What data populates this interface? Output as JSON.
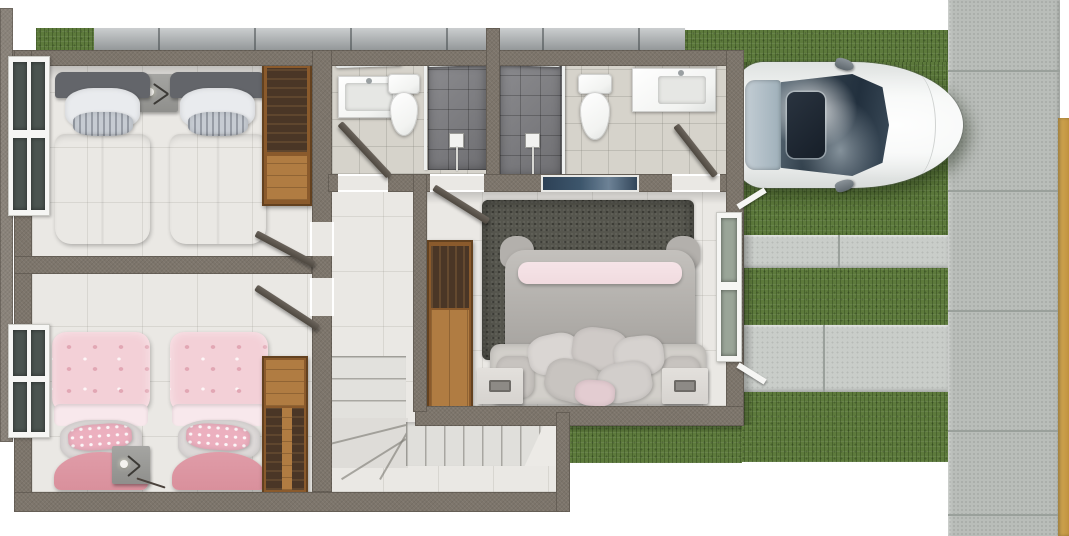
{
  "scene": {
    "type": "3d-floor-plan-top-view",
    "description": "Top-down 3D architectural rendering of an upper floor: two twin bedrooms on the left, two bathrooms at top center, a master bedroom at center right, an L-shaped staircase, and an exterior driveway with a parked white car, grass strips and a paver sidewalk"
  },
  "palette": {
    "background": "#ffffff",
    "wall": "#7d756b",
    "wall_dark": "#8a837a",
    "fence_stone": "#a8adaf",
    "floor": "#eae8e4",
    "bath_floor": "#d6d3cb",
    "shower_tile": "#7e7e82",
    "porcelain": "#f2f3f1",
    "wood": "#b07c42",
    "wood_mid": "#8a5a2c",
    "wood_dark": "#4a3626",
    "gray_bed_duvet": "#d4d8dc",
    "gray_bed_headboard": "#63656a",
    "pink_duvet": "#f3d0d7",
    "pink_accent": "#e2a7b4",
    "pink_blanket": "#d9909c",
    "master_duvet": "#b7b4b0",
    "master_pink_fold": "#f1dbdf",
    "master_headboard": "#d2cfca",
    "master_nightstand": "#d6d3cf",
    "rug": "#56564e",
    "grass": "#5d7a3c",
    "concrete_strip": "#c9cdc9",
    "sidewalk": "#b9bdb9",
    "paver_joint": "#9aa09b",
    "curb_tan": "#d2a853",
    "car_body": "#f4f6f5",
    "car_glass": "#2e3c48",
    "window_glass": "#4b5450",
    "window_blue": "#3d566c",
    "door": "#4e4840"
  },
  "house": {
    "rooms": [
      {
        "name": "twin bedroom gray",
        "beds": 2,
        "bedding": "light gray",
        "items": [
          "dark headboards",
          "nightstand with lamp",
          "wood wardrobe",
          "left window",
          "open door"
        ]
      },
      {
        "name": "twin bedroom pink",
        "beds": 2,
        "bedding": "pink patterned",
        "items": [
          "rose foot blankets",
          "nightstand with lamp",
          "wood wardrobe",
          "left window",
          "open door"
        ]
      },
      {
        "name": "bathroom left",
        "items": [
          "vanity sink",
          "mirror",
          "toilet",
          "dark tiled walk-in shower",
          "glass screen",
          "open door"
        ]
      },
      {
        "name": "bathroom right",
        "items": [
          "dark tiled walk-in shower",
          "glass screen",
          "toilet",
          "vanity sink",
          "mirror",
          "open door"
        ]
      },
      {
        "name": "master bedroom",
        "beds": 1,
        "bedding": "gray duvet with pink throw",
        "items": [
          "dark shag rug",
          "pillow cluster",
          "two light nightstands",
          "wood wardrobe",
          "right side window",
          "blue transom window",
          "open door"
        ]
      },
      {
        "name": "stair hall",
        "items": [
          "L-shaped staircase with winder steps"
        ]
      },
      {
        "name": "hallway",
        "items": []
      }
    ]
  },
  "exterior": {
    "fence": "gray stone block wall along the top",
    "lawn": "grass around driveway",
    "driveway": {
      "pattern": "alternating grass and concrete strips",
      "concrete_strips": 2,
      "grass_strips": 3
    },
    "sidewalk": {
      "orientation": "vertical right side",
      "paver_rows": 5
    },
    "curb": "tan strip at far right edge",
    "car": {
      "color": "white",
      "type": "sedan",
      "view": "top-down",
      "facing": "right",
      "features": [
        "dark windshield with cloud reflection",
        "sunroof",
        "side mirrors"
      ]
    }
  }
}
